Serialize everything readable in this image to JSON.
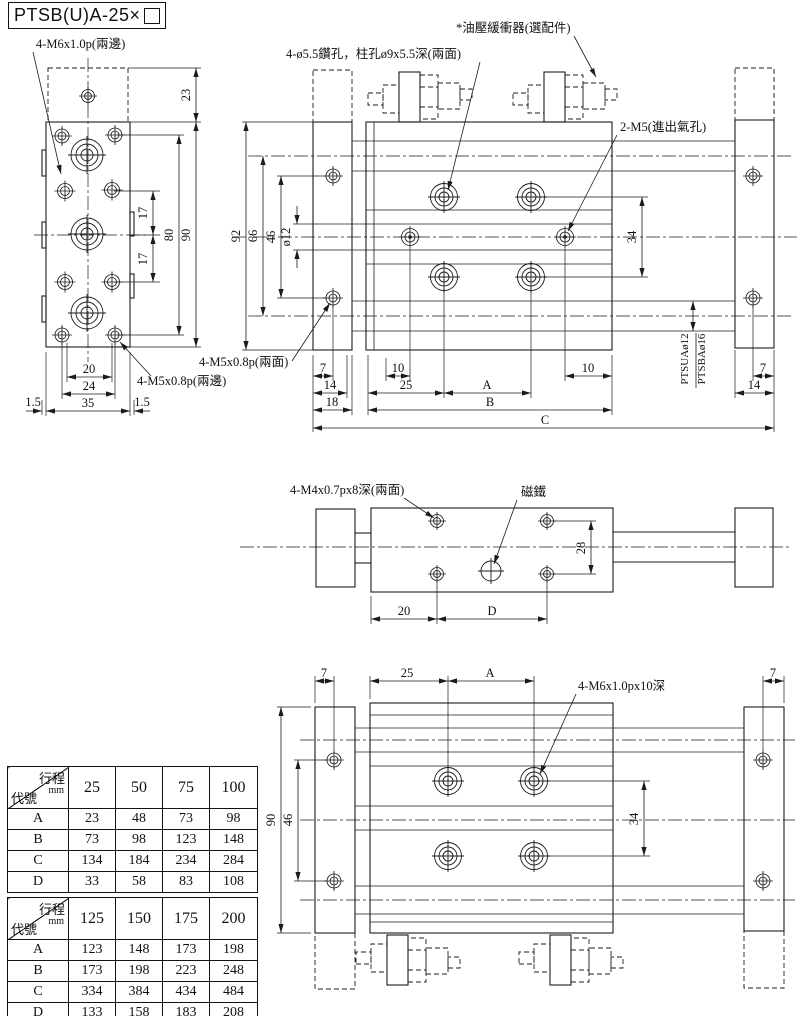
{
  "title": {
    "text": "PTSB(U)A-25×"
  },
  "front_view": {
    "label_m6": "4-M6x1.0p(兩邊)",
    "label_m5": "4-M5x0.8p(兩邊)",
    "d23": "23",
    "d17a": "17",
    "d17b": "17",
    "d80": "80",
    "d90": "90",
    "d20": "20",
    "d24": "24",
    "d35": "35",
    "d15l": "1.5",
    "d15r": "1.5"
  },
  "side_view": {
    "label_counterbore": "4-ø5.5鑽孔，柱孔ø9x5.5深(兩面)",
    "label_damper": "*油壓緩衝器(選配件)",
    "label_port": "2-M5(進出氣孔)",
    "label_m5_side": "4-M5x0.8p(兩面)",
    "rod_label_top": "PTSUAø12",
    "rod_label_bottom": "PTSBAø16",
    "d92": "92",
    "d66": "66",
    "d46": "46",
    "dia12": "ø12",
    "d34": "34",
    "d7l": "7",
    "d14l": "14",
    "d18": "18",
    "d10a": "10",
    "d25": "25",
    "dA": "A",
    "d10b": "10",
    "dB": "B",
    "dC": "C",
    "d7r": "7",
    "d14r": "14"
  },
  "top_view": {
    "label_m4": "4-M4x0.7px8深(兩面)",
    "label_magnet": "磁鐵",
    "d28": "28",
    "d20": "20",
    "dD": "D"
  },
  "bottom_view": {
    "label_m6deep": "4-M6x1.0px10深",
    "d7l": "7",
    "d25": "25",
    "dA": "A",
    "d7r": "7",
    "d90": "90",
    "d46": "46",
    "d34": "34"
  },
  "tables": [
    {
      "corner": {
        "top": "行程",
        "unit": "mm",
        "bottom": "代號"
      },
      "columns": [
        "25",
        "50",
        "75",
        "100"
      ],
      "rows": [
        {
          "code": "A",
          "values": [
            "23",
            "48",
            "73",
            "98"
          ]
        },
        {
          "code": "B",
          "values": [
            "73",
            "98",
            "123",
            "148"
          ]
        },
        {
          "code": "C",
          "values": [
            "134",
            "184",
            "234",
            "284"
          ]
        },
        {
          "code": "D",
          "values": [
            "33",
            "58",
            "83",
            "108"
          ]
        }
      ]
    },
    {
      "corner": {
        "top": "行程",
        "unit": "mm",
        "bottom": "代號"
      },
      "columns": [
        "125",
        "150",
        "175",
        "200"
      ],
      "rows": [
        {
          "code": "A",
          "values": [
            "123",
            "148",
            "173",
            "198"
          ]
        },
        {
          "code": "B",
          "values": [
            "173",
            "198",
            "223",
            "248"
          ]
        },
        {
          "code": "C",
          "values": [
            "334",
            "384",
            "434",
            "484"
          ]
        },
        {
          "code": "D",
          "values": [
            "133",
            "158",
            "183",
            "208"
          ]
        }
      ]
    }
  ],
  "colors": {
    "line": "#1b1b1b",
    "background": "#ffffff"
  }
}
